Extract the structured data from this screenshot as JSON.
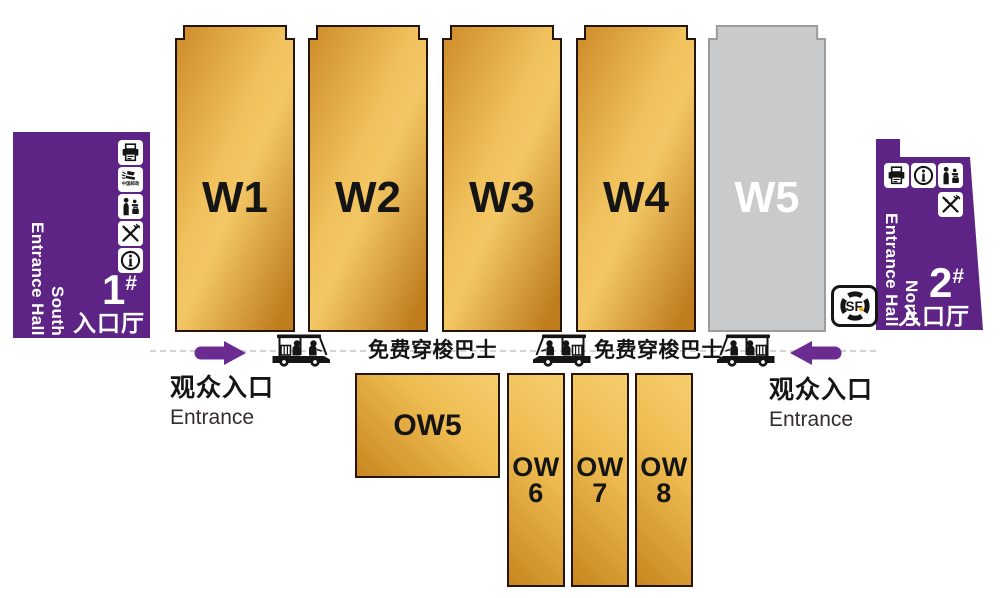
{
  "colors": {
    "purple_block": "#5d2385",
    "purple_arrow": "#6c2b90",
    "gold_light": "#f6cd6e",
    "gold_dark": "#c9861f",
    "hall_border": "#241508",
    "gray_hall": "#c9cacb",
    "gray_hall_border": "#9b9b9b",
    "sf_orange": "#f7a600",
    "dash_line": "#d4d4d4"
  },
  "halls": {
    "main": [
      {
        "label": "W1",
        "type": "gold"
      },
      {
        "label": "W2",
        "type": "gold"
      },
      {
        "label": "W3",
        "type": "gold"
      },
      {
        "label": "W4",
        "type": "gold"
      },
      {
        "label": "W5",
        "type": "gray"
      }
    ],
    "outer_wide": {
      "label": "OW5"
    },
    "outer": [
      {
        "line1": "OW",
        "line2": "6"
      },
      {
        "line1": "OW",
        "line2": "7"
      },
      {
        "line1": "OW",
        "line2": "8"
      }
    ]
  },
  "south_entrance_hall": {
    "name_top": "South",
    "name_bottom": "Entrance Hall",
    "number": "1",
    "number_mark": "#",
    "label_cn": "入口厅",
    "post_label": "中国邮政",
    "icons": [
      "printer-icon",
      "china-post-icon",
      "reception-icon",
      "dining-icon",
      "info-icon"
    ]
  },
  "north_entrance_hall": {
    "name_top": "North",
    "name_bottom": "Entrance Hall",
    "number": "2",
    "number_mark": "#",
    "label_cn": "入口厅",
    "icons": [
      "printer-icon",
      "info-icon",
      "reception-icon",
      "dining-icon"
    ]
  },
  "shuttle_bus": {
    "label": "免费穿梭巴士"
  },
  "visitor_entrance": {
    "label_cn": "观众入口",
    "label_en": "Entrance"
  },
  "sf_express": {
    "label": "SF"
  }
}
